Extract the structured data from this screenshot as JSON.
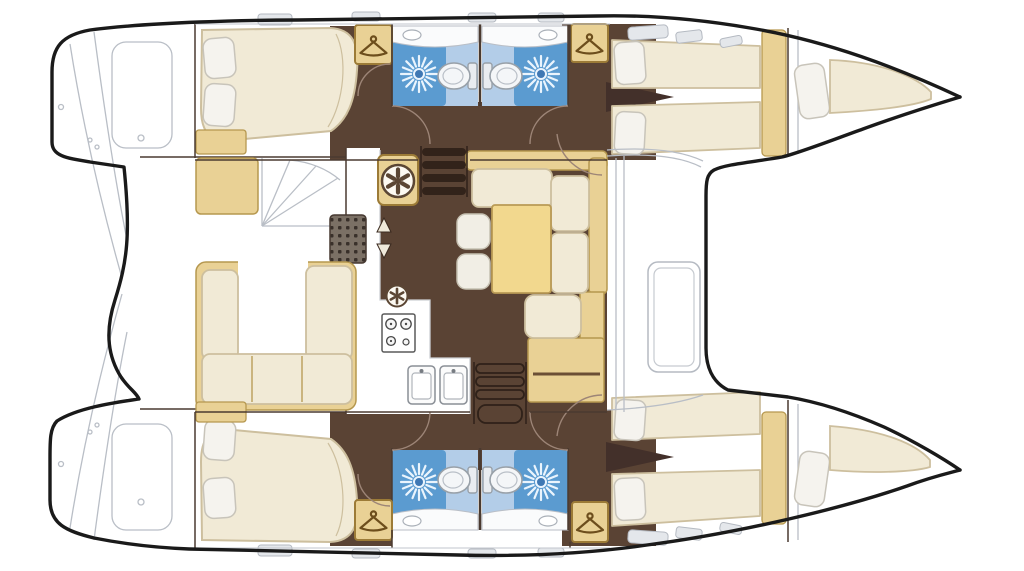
{
  "meta": {
    "title": "Catamaran yacht interior floor plan (top-down view)",
    "diagram_type": "boat-deck-plan",
    "orientation": "bow to the right, twin hulls top and bottom",
    "counts": {
      "double_cabins": 4,
      "bathrooms": 4,
      "forepeak_berths": 2,
      "wardrobes": 4,
      "companionway_steps": 2
    }
  },
  "regions": [
    {
      "id": "port-hull",
      "label": "port hull (top)"
    },
    {
      "id": "starboard-hull",
      "label": "starboard hull (bottom)"
    },
    {
      "id": "cockpit",
      "label": "aft cockpit with U-sofa"
    },
    {
      "id": "saloon",
      "label": "saloon with dinette and galley"
    },
    {
      "id": "galley",
      "label": "galley: stove, double sink, counter"
    },
    {
      "id": "dinette",
      "label": "L-sofa, table, two stools, nav seat"
    },
    {
      "id": "bathrooms",
      "label": "four heads with shower and toilet"
    },
    {
      "id": "forepeaks",
      "label": "bow single berths"
    },
    {
      "id": "foredeck",
      "label": "foredeck between hulls"
    }
  ],
  "icons": [
    {
      "name": "shower-icon",
      "glyph": "sunburst"
    },
    {
      "name": "toilet-icon",
      "glyph": "bowl-and-tank"
    },
    {
      "name": "hanger-icon",
      "glyph": "clothes-hanger"
    },
    {
      "name": "helm-fan-icon",
      "glyph": "wheel-with-spokes"
    },
    {
      "name": "stove-icon",
      "glyph": "burners"
    },
    {
      "name": "sink-icon",
      "glyph": "basin"
    },
    {
      "name": "steps-icon",
      "glyph": "ladder-bars"
    },
    {
      "name": "deck-hatch-icon",
      "glyph": "rounded-rectangle"
    }
  ],
  "colors": {
    "outline": "#1a1a1a",
    "line_gray": "#b9bec6",
    "wall": "#4a3a30",
    "floor": "#5a4334",
    "floor_dark": "#43302a",
    "cream": "#f1ead6",
    "cream_edge": "#cdbf9e",
    "tan": "#e9d195",
    "tan_edge": "#b6984f",
    "table": "#f2d88e",
    "table_edge": "#b99a55",
    "pillow": "#f5f3ee",
    "pillow_edge": "#c8c4ba",
    "blue": "#5b9bd0",
    "blue_light": "#b3cde8",
    "blue_ray": "#eaf4fd",
    "blue_center": "#3f78b4",
    "counter": "#fafbfc",
    "counter_edge": "#cdd0d4",
    "white": "#ffffff",
    "hatch": "#e4e7eb",
    "hatch_edge": "#b5bac2",
    "steps_bar": "#32231a",
    "steps_rail": "#2f2119",
    "grate": "#7b7065",
    "grate_dot": "#39302a",
    "fixture": "#f4f6f8",
    "fixture_edge": "#98a0a8",
    "icon_dark": "#5b4634",
    "hanger": "#6d4e1c",
    "arc": "#9d8577",
    "stool": "#f1eee5",
    "stool_edge": "#c6c1b2"
  }
}
